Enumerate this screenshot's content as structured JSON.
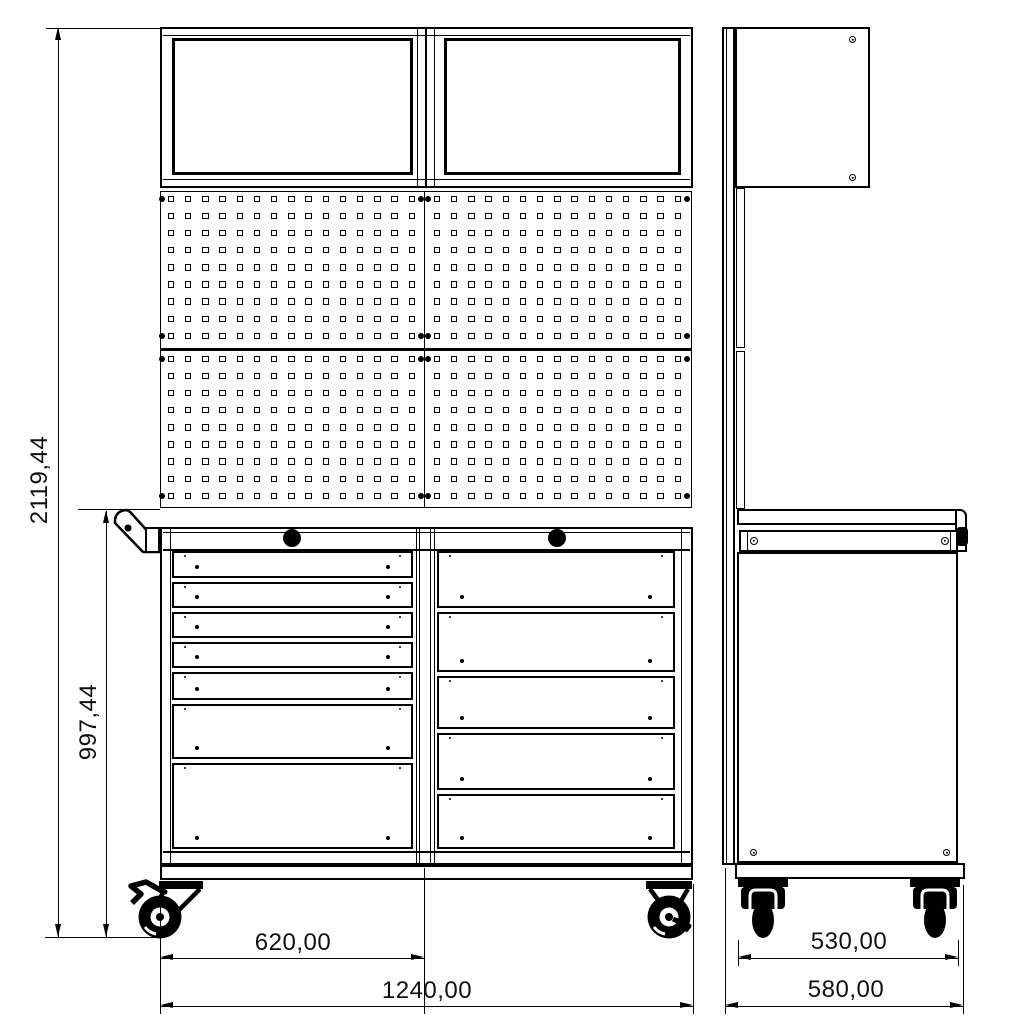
{
  "labels": {
    "total_height": "2119,44",
    "cart_height": "997,44",
    "half_width": "620,00",
    "total_width": "1240,00",
    "caster_track": "530,00",
    "total_depth": "580,00"
  },
  "front_view": {
    "wall_cabinet_count": 2,
    "pegboard": {
      "panel_grid": "2x2",
      "hole_rows": 9,
      "hole_cols": 15,
      "corner_fasteners_per_panel": 4
    },
    "drawer_columns": [
      {
        "side": "left",
        "drawer_heights": [
          27,
          26,
          26,
          26,
          28,
          55,
          86
        ]
      },
      {
        "side": "right",
        "drawer_heights": [
          57,
          60,
          53,
          57,
          55
        ]
      }
    ],
    "lock_knob_count": 2,
    "caster_count": 2,
    "handle": "push-handle-left"
  },
  "side_view": {
    "caster_count": 2,
    "screw_count": 6,
    "has_wall_panel_post": true,
    "has_worktop": true
  },
  "line_color": "#000000",
  "background_color": "#ffffff"
}
